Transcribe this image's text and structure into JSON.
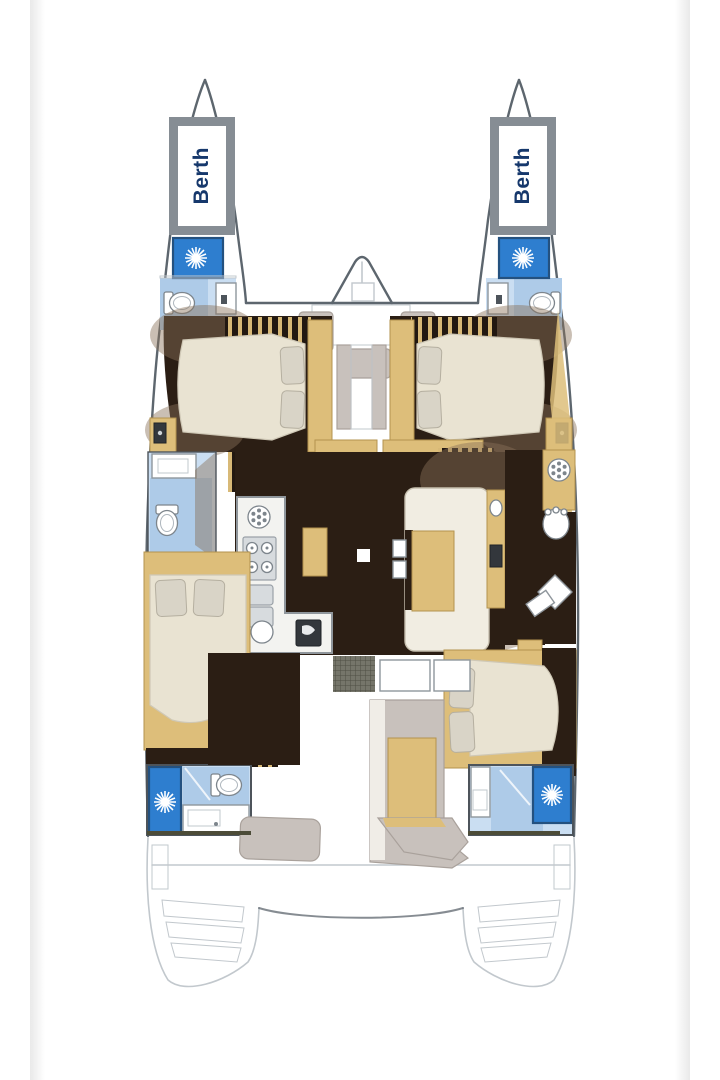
{
  "figure": {
    "kind": "catamaran-deck-plan"
  },
  "labels": {
    "port_berth": "Berth",
    "starboard_berth": "Berth"
  },
  "colors": {
    "page-bg": "#ffffff",
    "margin-band": "#e9e9e9",
    "outline": "#5d666e",
    "faint-outline": "#c2c8cd",
    "berth-border": "#868d94",
    "berth-text": "#16386c",
    "shower-blue": "#2e7ecf",
    "shower-border": "#24517f",
    "bath-floor": "#aecbe8",
    "bath-floor-light": "#cadef2",
    "floor-dark": "#2b1e14",
    "shadow-brown": "#8a7258",
    "wood-tan": "#ddbe7a",
    "wood-tan-dark": "#b3934f",
    "bed-cream": "#e9e3d2",
    "pillow": "#d9d4c7",
    "seat-gray": "#c8c1bc",
    "seat-gray-dark": "#a9a19b",
    "counter-border": "#8f969c",
    "metal-gray": "#9aa1a8",
    "deck-line-olive": "#4c4c38",
    "appliance-dark": "#33373c"
  },
  "icons": {
    "shower": "starburst-icon",
    "toilet": "toilet-top-view-icon",
    "stove": "four-burner-stove-icon",
    "galley_sink": "double-sink-icon",
    "round_sink": "round-sink-icon",
    "fridge": "fridge-icon",
    "hatch": "spoke-wheel-icon",
    "speaker": "speaker-icon",
    "washbasin": "washbasin-icon"
  }
}
